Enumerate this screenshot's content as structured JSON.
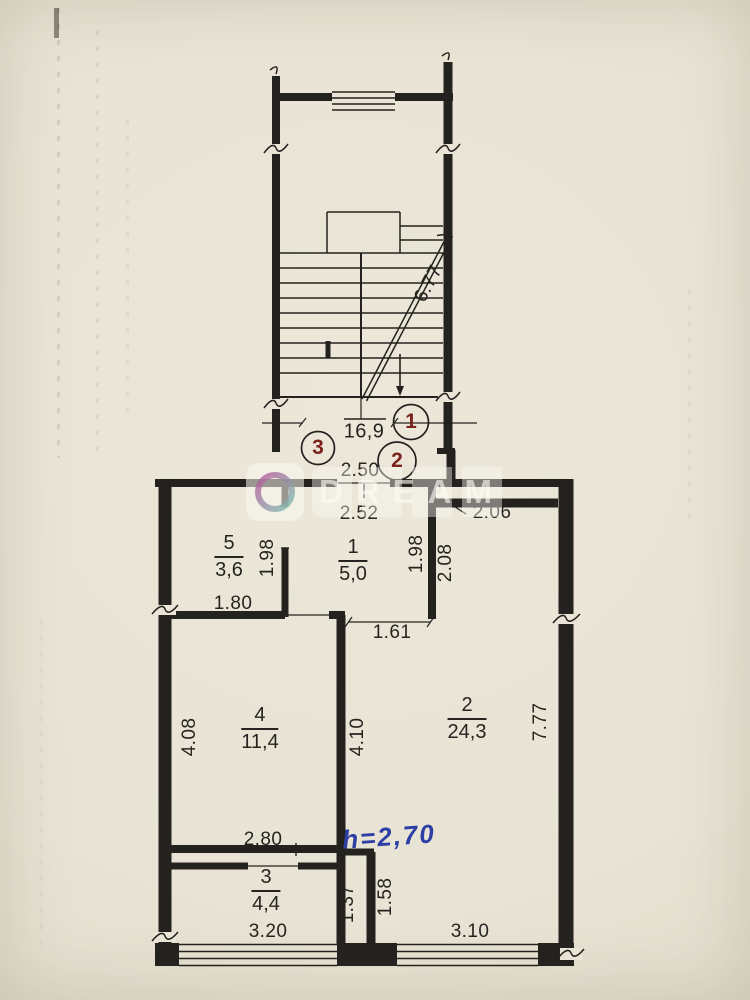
{
  "colors": {
    "paper": "#e9e4d6",
    "ink": "#24221e",
    "marker_red": "#7c221c",
    "note_blue": "#2d3fa5",
    "watermark_pink": "#b8569b",
    "watermark_teal": "#7cc2b0"
  },
  "plan": {
    "stair_flight_dim": "6.77",
    "landing_area": "16,9",
    "markers": {
      "m1": "1",
      "m2": "2",
      "m3": "3"
    },
    "rooms": {
      "r1": {
        "number": "1",
        "area": "5,0"
      },
      "r2": {
        "number": "2",
        "area": "24,3"
      },
      "r3": {
        "number": "3",
        "area": "4,4"
      },
      "r4": {
        "number": "4",
        "area": "11,4"
      },
      "r5": {
        "number": "5",
        "area": "3,6"
      }
    },
    "dims": {
      "d2_50": "2.50",
      "d2_52": "2.52",
      "d2_06": "2.06",
      "d1_98_left": "1.98",
      "d1_98_right": "1.98",
      "d2_08": "2.08",
      "d1_80": "1.80",
      "d1_61": "1.61",
      "d4_08": "4.08",
      "d4_10": "4.10",
      "d7_77": "7.77",
      "d2_80": "2.80",
      "d1_37": "1.37",
      "d1_58": "1.58",
      "d3_20": "3.20",
      "d3_10": "3.10"
    },
    "height_note": "h=2,70",
    "watermark_text": "DREAM"
  }
}
